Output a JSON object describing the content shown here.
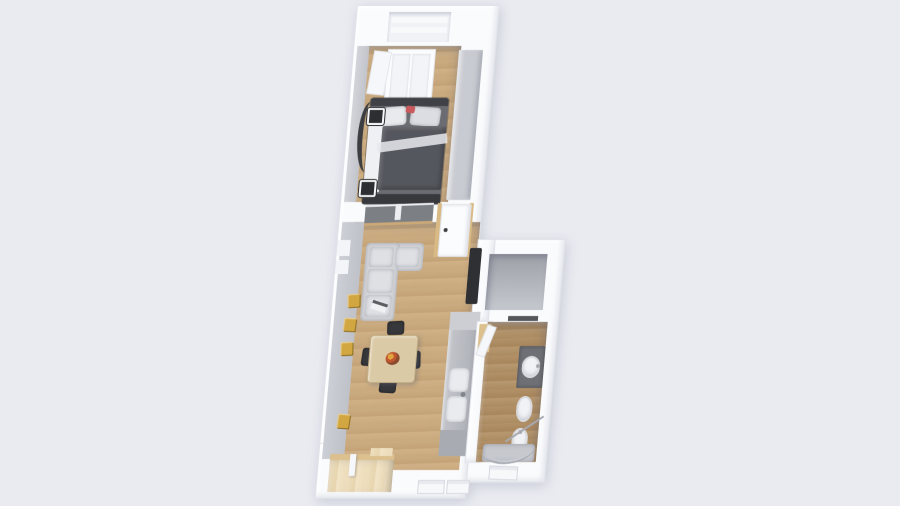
{
  "scene": {
    "type": "3d-floorplan-render",
    "description": "Top-down 3D render of a narrow one-bedroom apartment with bedroom, living-dining room, kitchen counter, storage room, bathroom and entry alcove",
    "background": "#eaebf1"
  },
  "colors": {
    "wall": "#fafbfd",
    "wall_edge": "#e0e2e9",
    "wall_face": "#c6c8cf",
    "window_recess": "#f0f2f6",
    "wood_light": "#c8a87c",
    "wood_dark": "#ab8b60",
    "floor_gray": "#b7b9c1",
    "floor_cream": "#ecdcba",
    "threshold_wood": "#dcc08e",
    "closet_gray": "#c9cbd2",
    "sofa": "#d3d4d8",
    "sofa_cushion": "#dfe0e4",
    "bed_frame": "#6a6c72",
    "bed_duvet": "#55575e",
    "bed_headboard": "#3f4146",
    "bed_bench": "#37393d",
    "pillow": "#e9eaee",
    "accent_red": "#c9595c",
    "counter": "#b5b7be",
    "counter_cap": "#ccced4",
    "counter_dark": "#a9abb2",
    "table_wood": "#dbcaa6",
    "chair_dark": "#37383c",
    "art_gold": "#d2a640",
    "tv_dark": "#2e3033",
    "glass_dark": "#7c8085",
    "door_wood": "#d9ba85",
    "fixture_white": "#f1f2f5",
    "vanity_dark": "#6e7076",
    "chrome": "#a6a9af"
  },
  "rooms": [
    {
      "id": "bedroom",
      "floor": "light-wood",
      "items": [
        "wardrobe",
        "double-bed",
        "pillows",
        "duvet",
        "foot-bench",
        "built-in-closet",
        "wall-mirror",
        "wall-frame-upper",
        "wall-frame-lower"
      ]
    },
    {
      "id": "living-dining",
      "floor": "light-wood",
      "items": [
        "corner-sofa",
        "sofa-magazine",
        "wall-art-1",
        "wall-art-2",
        "wall-art-3",
        "wall-art-4",
        "dining-table",
        "fruit-bowl",
        "chair-north",
        "chair-west",
        "chair-east",
        "chair-south",
        "kitchen-counter",
        "kitchen-sink",
        "wall-tv",
        "interior-window",
        "interior-door"
      ]
    },
    {
      "id": "storage",
      "floor": "gray",
      "items": []
    },
    {
      "id": "bathroom",
      "floor": "dark-wood",
      "items": [
        "vanity-sink",
        "toilet",
        "bidet",
        "shower",
        "door-threshold",
        "wall-mirror-strip"
      ]
    },
    {
      "id": "entry-alcove",
      "floor": "cream",
      "items": [
        "wood-threshold",
        "partition"
      ]
    }
  ],
  "openings": {
    "top_exterior_window_count": 1,
    "left_wall_window_notches": 2,
    "bottom_exterior_windows": 3
  }
}
